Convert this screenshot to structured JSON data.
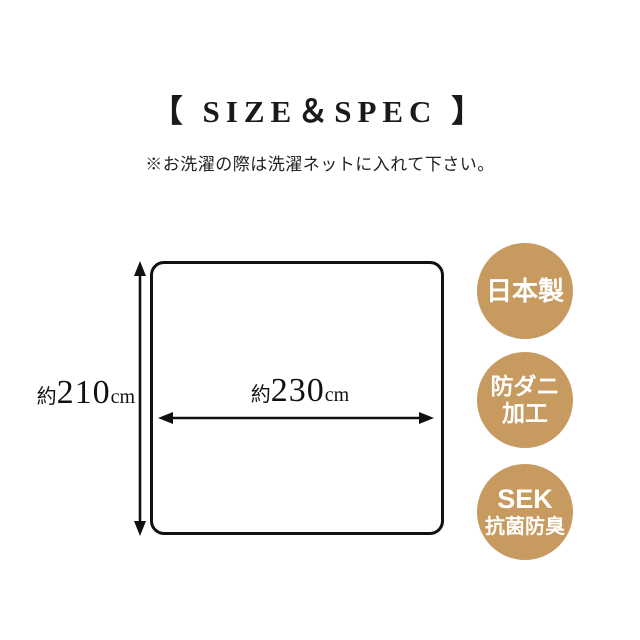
{
  "page": {
    "title": "【 SIZE＆SPEC 】",
    "note": "※お洗濯の際は洗濯ネットに入れて下さい。"
  },
  "diagram": {
    "height_label": {
      "prefix": "約",
      "value": "210",
      "unit": "cm"
    },
    "width_label": {
      "prefix": "約",
      "value": "230",
      "unit": "cm"
    }
  },
  "badges": [
    {
      "lines": [
        "日本製"
      ]
    },
    {
      "lines": [
        "防ダニ",
        "加工"
      ]
    },
    {
      "lines": [
        "SEK",
        "抗菌防臭"
      ]
    }
  ],
  "colors": {
    "badge_background": "#C79B60",
    "badge_text": "#FFFFFF",
    "line_color": "#111111"
  }
}
